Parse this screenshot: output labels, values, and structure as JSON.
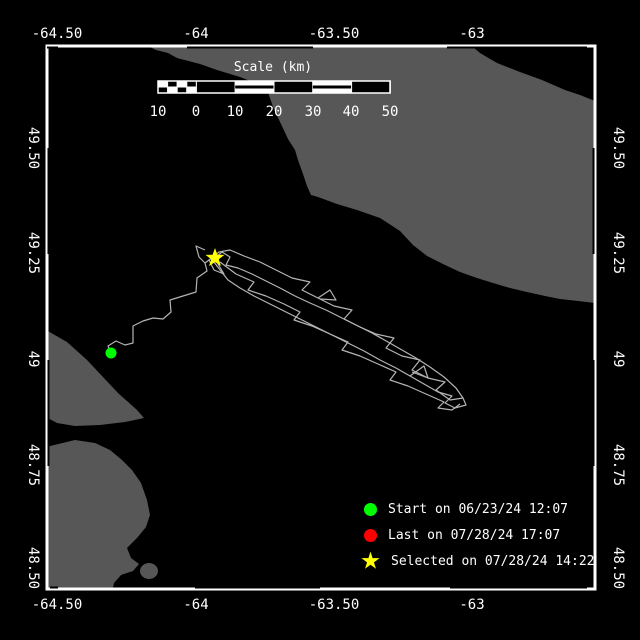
{
  "colors": {
    "background": "#000000",
    "land": "#575757",
    "water": "#000000",
    "frame": "#ffffff",
    "track": "#b4b4b4",
    "text": "#ffffff",
    "start": "#00ff00",
    "last": "#ff0000",
    "selected": "#ffff00"
  },
  "frame": {
    "left": 47,
    "top": 46,
    "right": 595,
    "bottom": 589,
    "zebra_top_x": [
      [
        47,
        58
      ],
      [
        187,
        313
      ],
      [
        447,
        587
      ]
    ],
    "zebra_bottom_x": [
      [
        50,
        58
      ],
      [
        195,
        320
      ],
      [
        450,
        587
      ]
    ],
    "zebra_side_y": [
      [
        148,
        254
      ],
      [
        360,
        466
      ]
    ]
  },
  "axis": {
    "lon_labels": [
      {
        "text": "-64.50",
        "x": 57
      },
      {
        "text": "-64",
        "x": 196
      },
      {
        "text": "-63.50",
        "x": 334
      },
      {
        "text": "-63",
        "x": 472
      }
    ],
    "lat_labels": [
      {
        "text": "49.50",
        "y": 148
      },
      {
        "text": "49.25",
        "y": 253
      },
      {
        "text": "49",
        "y": 359
      },
      {
        "text": "48.75",
        "y": 465
      },
      {
        "text": "48.50",
        "y": 568
      }
    ],
    "top_label_y": 27,
    "bottom_label_y": 598,
    "left_label_x": 33,
    "right_label_x": 618
  },
  "scale_bar": {
    "title": "Scale (km)",
    "title_x": 273,
    "title_y": 60,
    "bar": {
      "x": 158,
      "y": 81,
      "w": 232,
      "h": 12
    },
    "zero_x": 196.4,
    "px_per_km": 3.88,
    "labels": [
      {
        "text": "10",
        "x": 158
      },
      {
        "text": "0",
        "x": 196
      },
      {
        "text": "10",
        "x": 235
      },
      {
        "text": "20",
        "x": 274
      },
      {
        "text": "30",
        "x": 313
      },
      {
        "text": "40",
        "x": 351
      },
      {
        "text": "50",
        "x": 390
      }
    ],
    "labels_y": 104
  },
  "legend": {
    "x": 364,
    "items": [
      {
        "marker": "circle",
        "color": "#00ff00",
        "label": "Start on 06/23/24 12:07",
        "y": 509
      },
      {
        "marker": "circle",
        "color": "#ff0000",
        "label": "Last on 07/28/24 17:07",
        "y": 535
      },
      {
        "marker": "star",
        "color": "#ffff00",
        "label": "Selected on 07/28/24 14:22",
        "y": 561
      }
    ]
  },
  "map_data": {
    "land": [
      {
        "name": "land-anticosti-island",
        "path": "M150,47 L473,47 L480,53 L497,63 L520,72 L542,80 L565,90 L580,95 L595,101 L595,303 L578,301 L560,299 L545,296 L527,292 L510,288 L493,283 L477,278 L460,272 L445,265 L427,256 L413,245 L400,231 L380,218 L357,210 L337,204 L318,197 L311,195 L307,186 L303,174 L298,160 L295,150 L288,139 L281,124 L273,107 L268,92 L258,84 L240,77 L217,70 L200,64 L177,58 L168,53 L156,50 Z"
      },
      {
        "name": "land-gaspe-spit",
        "path": "M46,330 L67,342 L87,360 L103,377 L118,393 L137,410 L144,418 L125,422 L100,425 L75,426 L57,423 L46,417 Z"
      },
      {
        "name": "land-gaspe-peninsula",
        "path": "M46,447 L75,440 L95,443 L110,450 L122,460 L132,470 L141,483 L147,500 L150,515 L146,527 L137,538 L127,548 L131,558 L139,564 L133,571 L121,575 L114,583 L112,592 L46,592 Z"
      },
      {
        "name": "land-small-island",
        "ellipse": {
          "cx": 149,
          "cy": 571,
          "rx": 9,
          "ry": 8
        }
      }
    ],
    "track": [
      [
        [
          111,
          353
        ],
        [
          108,
          346
        ],
        [
          116,
          341
        ],
        [
          125,
          345
        ],
        [
          133,
          343
        ],
        [
          133,
          326
        ],
        [
          143,
          321
        ],
        [
          153,
          318
        ],
        [
          163,
          319
        ],
        [
          171,
          312
        ],
        [
          170,
          300
        ],
        [
          183,
          296
        ],
        [
          196,
          292
        ],
        [
          197,
          278
        ],
        [
          207,
          271
        ],
        [
          205,
          263
        ],
        [
          213,
          257
        ],
        [
          215,
          258
        ],
        [
          222,
          252
        ],
        [
          230,
          257
        ],
        [
          226,
          265
        ],
        [
          238,
          268
        ],
        [
          252,
          274
        ],
        [
          266,
          281
        ],
        [
          280,
          288
        ],
        [
          295,
          296
        ],
        [
          310,
          303
        ],
        [
          326,
          310
        ],
        [
          342,
          318
        ],
        [
          358,
          326
        ],
        [
          372,
          333
        ],
        [
          388,
          342
        ],
        [
          402,
          350
        ],
        [
          416,
          358
        ],
        [
          430,
          367
        ],
        [
          444,
          377
        ],
        [
          456,
          388
        ],
        [
          463,
          398
        ],
        [
          466,
          405
        ],
        [
          455,
          408
        ],
        [
          445,
          403
        ],
        [
          452,
          396
        ],
        [
          438,
          392
        ],
        [
          424,
          384
        ],
        [
          410,
          376
        ],
        [
          396,
          368
        ],
        [
          380,
          360
        ],
        [
          364,
          351
        ],
        [
          350,
          344
        ],
        [
          334,
          336
        ],
        [
          318,
          328
        ],
        [
          302,
          320
        ],
        [
          286,
          312
        ],
        [
          270,
          304
        ],
        [
          254,
          296
        ],
        [
          240,
          288
        ],
        [
          228,
          280
        ],
        [
          220,
          270
        ],
        [
          214,
          262
        ]
      ],
      [
        [
          463,
          398
        ],
        [
          450,
          400
        ],
        [
          436,
          390
        ],
        [
          445,
          382
        ],
        [
          428,
          378
        ],
        [
          412,
          370
        ],
        [
          420,
          360
        ],
        [
          402,
          356
        ],
        [
          386,
          348
        ],
        [
          394,
          338
        ],
        [
          376,
          334
        ],
        [
          360,
          327
        ],
        [
          344,
          319
        ],
        [
          352,
          310
        ],
        [
          334,
          306
        ],
        [
          318,
          298
        ],
        [
          302,
          290
        ],
        [
          310,
          282
        ],
        [
          292,
          278
        ],
        [
          276,
          270
        ],
        [
          260,
          262
        ],
        [
          244,
          256
        ],
        [
          230,
          250
        ],
        [
          219,
          252
        ],
        [
          209,
          260
        ],
        [
          214,
          270
        ],
        [
          224,
          274
        ],
        [
          218,
          264
        ]
      ],
      [
        [
          220,
          262
        ],
        [
          236,
          274
        ],
        [
          254,
          282
        ],
        [
          248,
          290
        ],
        [
          266,
          296
        ],
        [
          284,
          304
        ],
        [
          300,
          312
        ],
        [
          294,
          320
        ],
        [
          312,
          326
        ],
        [
          330,
          334
        ],
        [
          348,
          342
        ],
        [
          342,
          350
        ],
        [
          360,
          356
        ],
        [
          378,
          364
        ],
        [
          396,
          372
        ],
        [
          390,
          380
        ],
        [
          408,
          386
        ],
        [
          426,
          394
        ],
        [
          444,
          402
        ],
        [
          438,
          408
        ],
        [
          452,
          410
        ],
        [
          460,
          404
        ]
      ],
      [
        [
          318,
          298
        ],
        [
          330,
          290
        ],
        [
          336,
          300
        ],
        [
          320,
          299
        ]
      ],
      [
        [
          410,
          376
        ],
        [
          424,
          366
        ],
        [
          428,
          378
        ],
        [
          412,
          372
        ]
      ],
      [
        [
          205,
          250
        ],
        [
          196,
          246
        ],
        [
          199,
          257
        ],
        [
          205,
          263
        ]
      ]
    ],
    "markers": {
      "start": {
        "x": 111,
        "y": 353,
        "r": 5.5
      },
      "selected": {
        "x": 215,
        "y": 258,
        "r_out": 10,
        "r_in": 4
      }
    }
  }
}
